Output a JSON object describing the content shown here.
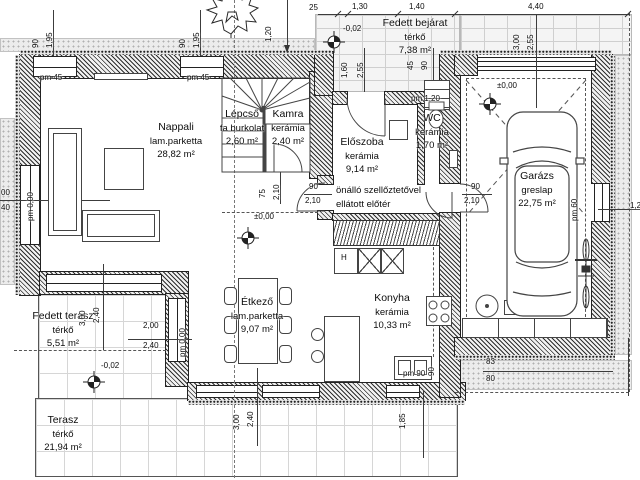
{
  "drawing": {
    "rooms": [
      {
        "name": "Nappali",
        "floor": "lam.parketta",
        "area": "28,82 m²",
        "x": 176,
        "y": 121
      },
      {
        "name": "Lépcső",
        "floor": "fa burkolat",
        "area": "2,60 m²",
        "x": 242,
        "y": 108
      },
      {
        "name": "Kamra",
        "floor": "kerámia",
        "area": "2,40 m²",
        "x": 288,
        "y": 108
      },
      {
        "name": "Előszoba",
        "floor": "kerámia",
        "area": "9,14 m²",
        "x": 362,
        "y": 136
      },
      {
        "name": "WC",
        "floor": "kerámia",
        "area": "1,70 m²",
        "x": 432,
        "y": 112
      },
      {
        "name": "Fedett bejárat",
        "floor": "térkő",
        "area": "7,38 m²",
        "x": 415,
        "y": 17
      },
      {
        "name": "Garázs",
        "floor": "greslap",
        "area": "22,75 m²",
        "x": 537,
        "y": 170
      },
      {
        "name": "Konyha",
        "floor": "kerámia",
        "area": "10,33 m²",
        "x": 392,
        "y": 292
      },
      {
        "name": "Étkező",
        "floor": "lam.parketta",
        "area": "9,07 m²",
        "x": 257,
        "y": 296
      },
      {
        "name": "Fedett terasz",
        "floor": "térkő",
        "area": "5,51 m²",
        "x": 63,
        "y": 310
      },
      {
        "name": "Terasz",
        "floor": "térkő",
        "area": "21,94 m²",
        "x": 63,
        "y": 414
      }
    ],
    "notes": [
      {
        "text": "önálló szellőztetővel",
        "x": 336,
        "y": 185
      },
      {
        "text": "ellátott előtér",
        "x": 336,
        "y": 199
      }
    ],
    "dims": [
      {
        "t": "90",
        "x": 40,
        "y": 48,
        "r": 1
      },
      {
        "t": "1,95",
        "x": 54,
        "y": 48,
        "r": 1
      },
      {
        "t": "90",
        "x": 187,
        "y": 48,
        "r": 1
      },
      {
        "t": "1,95",
        "x": 201,
        "y": 48,
        "r": 1
      },
      {
        "t": "1,20",
        "x": 273,
        "y": 42,
        "r": 1
      },
      {
        "t": "3,00",
        "x": 521,
        "y": 50,
        "r": 1
      },
      {
        "t": "2,55",
        "x": 535,
        "y": 50,
        "r": 1
      },
      {
        "t": "1,60",
        "x": 349,
        "y": 78,
        "r": 1
      },
      {
        "t": "2,55",
        "x": 365,
        "y": 78,
        "r": 1
      },
      {
        "t": "45",
        "x": 415,
        "y": 70,
        "r": 1
      },
      {
        "t": "90",
        "x": 429,
        "y": 70,
        "r": 1
      },
      {
        "t": "pm 0,00",
        "x": 35,
        "y": 221,
        "r": 1
      },
      {
        "t": "75",
        "x": 267,
        "y": 198,
        "r": 1
      },
      {
        "t": "2,10",
        "x": 281,
        "y": 200,
        "r": 1
      },
      {
        "t": "pm 60",
        "x": 579,
        "y": 221,
        "r": 1
      },
      {
        "t": "90",
        "x": 436,
        "y": 376,
        "r": 1
      },
      {
        "t": "1,85",
        "x": 407,
        "y": 429,
        "r": 1
      },
      {
        "t": "3,00",
        "x": 241,
        "y": 430,
        "r": 1
      },
      {
        "t": "2,40",
        "x": 255,
        "y": 427,
        "r": 1
      },
      {
        "t": "3,00",
        "x": 87,
        "y": 326,
        "r": 1
      },
      {
        "t": "2,40",
        "x": 101,
        "y": 323,
        "r": 1
      },
      {
        "t": "pm 0,00",
        "x": 187,
        "y": 357,
        "r": 1
      },
      {
        "t": "25",
        "x": 309,
        "y": 3
      },
      {
        "t": "1,30",
        "x": 352,
        "y": 2
      },
      {
        "t": "1,40",
        "x": 409,
        "y": 2
      },
      {
        "t": "4,40",
        "x": 528,
        "y": 2
      },
      {
        "t": "-0,02",
        "x": 343,
        "y": 24
      },
      {
        "t": "pm 45",
        "x": 40,
        "y": 73
      },
      {
        "t": "pm 45",
        "x": 187,
        "y": 73
      },
      {
        "t": "pm 1,20",
        "x": 411,
        "y": 94
      },
      {
        "t": "00",
        "x": 1,
        "y": 188
      },
      {
        "t": "40",
        "x": 1,
        "y": 203
      },
      {
        "t": "90",
        "x": 309,
        "y": 182
      },
      {
        "t": "2,10",
        "x": 305,
        "y": 196
      },
      {
        "t": "90",
        "x": 471,
        "y": 182
      },
      {
        "t": "2,10",
        "x": 464,
        "y": 196
      },
      {
        "t": "±0,00",
        "x": 254,
        "y": 212
      },
      {
        "t": "±0,00",
        "x": 497,
        "y": 81
      },
      {
        "t": "1,2",
        "x": 630,
        "y": 201
      },
      {
        "t": "pm 90",
        "x": 403,
        "y": 369
      },
      {
        "t": "83",
        "x": 486,
        "y": 357
      },
      {
        "t": "80",
        "x": 486,
        "y": 374
      },
      {
        "t": "2,00",
        "x": 143,
        "y": 321
      },
      {
        "t": "2,40",
        "x": 143,
        "y": 341
      },
      {
        "t": "-0,02",
        "x": 101,
        "y": 361
      },
      {
        "t": "H",
        "x": 341,
        "y": 253
      }
    ]
  }
}
